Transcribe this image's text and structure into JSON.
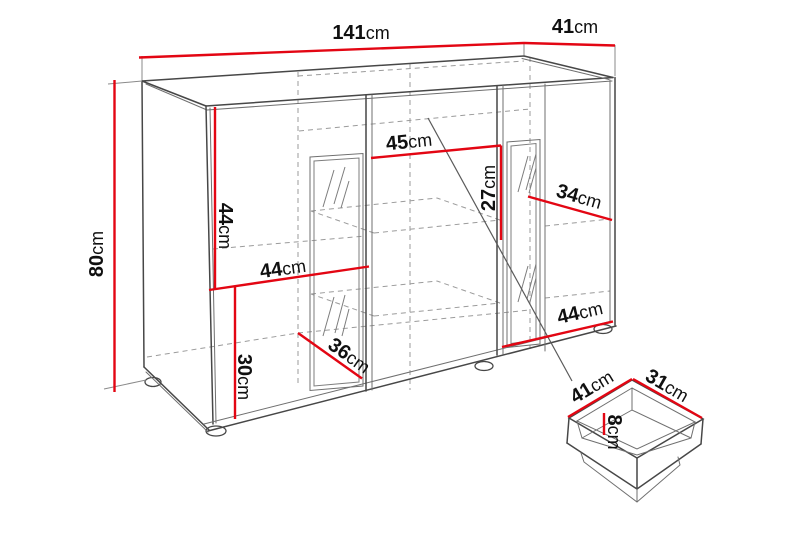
{
  "diagram": {
    "type": "furniture-dimension-diagram",
    "subject": "sideboard cabinet with open drawer detail",
    "accent_color": "#e30613",
    "line_color": "#474747",
    "dashed_color": "#9b9b9b",
    "unit": "cm",
    "cabinet": {
      "dimensions": {
        "width": {
          "value": "141",
          "unit": "cm"
        },
        "depth": {
          "value": "41",
          "unit": "cm"
        },
        "height": {
          "value": "80",
          "unit": "cm"
        },
        "left_section_height": {
          "value": "44",
          "unit": "cm"
        },
        "left_section_width": {
          "value": "44",
          "unit": "cm"
        },
        "bottom_section_height": {
          "value": "30",
          "unit": "cm"
        },
        "center_shelf_width": {
          "value": "45",
          "unit": "cm"
        },
        "center_shelf_height": {
          "value": "27",
          "unit": "cm"
        },
        "right_door_width": {
          "value": "34",
          "unit": "cm"
        },
        "right_section_width": {
          "value": "44",
          "unit": "cm"
        },
        "interior_depth": {
          "value": "36",
          "unit": "cm"
        }
      }
    },
    "drawer": {
      "dimensions": {
        "width": {
          "value": "41",
          "unit": "cm"
        },
        "depth": {
          "value": "31",
          "unit": "cm"
        },
        "height": {
          "value": "8",
          "unit": "cm"
        }
      }
    }
  }
}
